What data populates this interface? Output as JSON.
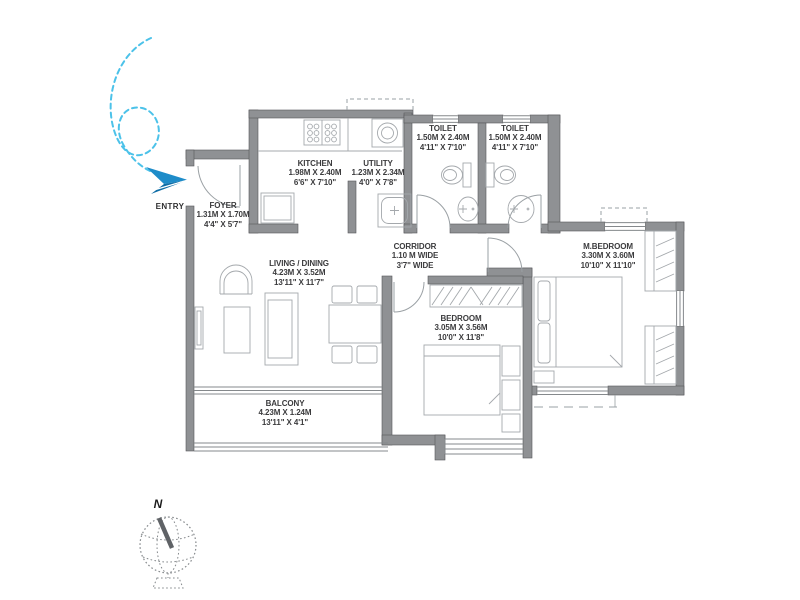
{
  "plan": {
    "entry_label": "ENTRY",
    "compass_label": "N",
    "rooms": [
      {
        "id": "foyer",
        "name": "FOYER",
        "size_m": "1.31M X 1.70M",
        "size_ft": "4'4\" X 5'7\""
      },
      {
        "id": "kitchen",
        "name": "KITCHEN",
        "size_m": "1.98M X 2.40M",
        "size_ft": "6'6\" X 7'10\""
      },
      {
        "id": "utility",
        "name": "UTILITY",
        "size_m": "1.23M X 2.34M",
        "size_ft": "4'0\" X 7'8\""
      },
      {
        "id": "toilet-1",
        "name": "TOILET",
        "size_m": "1.50M X 2.40M",
        "size_ft": "4'11\" X 7'10\""
      },
      {
        "id": "toilet-2",
        "name": "TOILET",
        "size_m": "1.50M X 2.40M",
        "size_ft": "4'11\" X 7'10\""
      },
      {
        "id": "living-dining",
        "name": "LIVING / DINING",
        "size_m": "4.23M X 3.52M",
        "size_ft": "13'11\" X 11'7\""
      },
      {
        "id": "corridor",
        "name": "CORRIDOR",
        "size_m": "1.10 M WIDE",
        "size_ft": "3'7\" WIDE"
      },
      {
        "id": "bedroom",
        "name": "BEDROOM",
        "size_m": "3.05M X 3.56M",
        "size_ft": "10'0\" X 11'8\""
      },
      {
        "id": "m-bedroom",
        "name": "M.BEDROOM",
        "size_m": "3.30M X 3.60M",
        "size_ft": "10'10\" X 11'10\""
      },
      {
        "id": "balcony",
        "name": "BALCONY",
        "size_m": "4.23M X 1.24M",
        "size_ft": "13'11\" X 4'1\""
      }
    ],
    "colors": {
      "wall": "#8f9194",
      "furniture_line": "#a4a8ac",
      "window_line": "#85898c",
      "text": "#3b3b3d",
      "swirl_blue": "#4cc2e9",
      "plane_blue": "#1e8cc9",
      "plane_blue_dark": "#0e6da6"
    }
  }
}
